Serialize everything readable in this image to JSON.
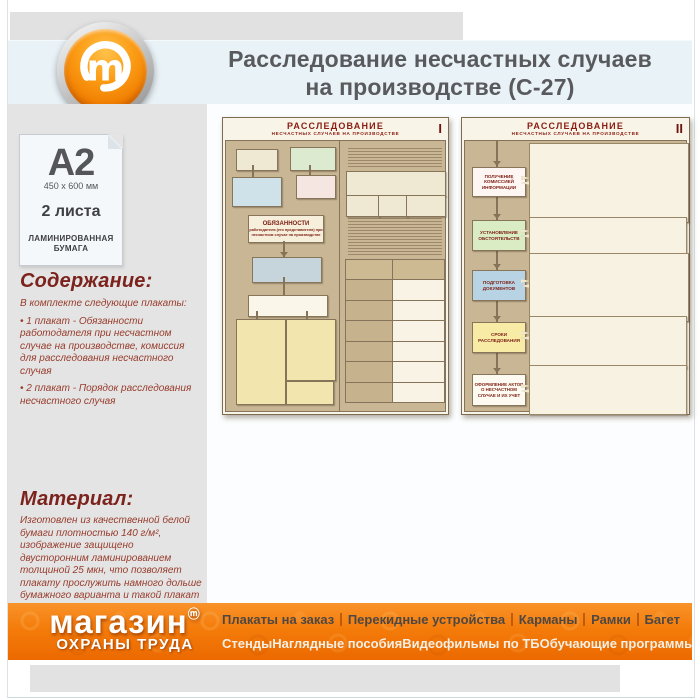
{
  "header": {
    "title_line1": "Расследование несчастных случаев",
    "title_line2": "на производстве (С-27)",
    "logo_letter": "m"
  },
  "sidebar": {
    "paper_format": "A2",
    "paper_size": "450 x 600 мм",
    "sheets": "2 листа",
    "paper_type_line1": "ЛАМИНИРОВАННАЯ",
    "paper_type_line2": "БУМАГА",
    "contents_heading": "Содержание:",
    "contents_intro": "В комплекте следующие плакаты:",
    "contents_item1": "• 1 плакат - Обязанности работодателя при несчастном случае на производстве, комиссия для расследования несчастного случая",
    "contents_item2": "• 2 плакат - Порядок расследования несчастного случая",
    "material_heading": "Материал:",
    "material_text": "Изготовлен из качественной белой бумаги плотностью 140 г/м², изображение защищено двусторонним ламинированием толщиной 25 мкн, что позволяет плакату прослужить намного дольше бумажного варианта и такой плакат не боится влаги - его смело можно протирать."
  },
  "posters": {
    "poster1": {
      "title": "РАССЛЕДОВАНИЕ",
      "subtitle": "НЕСЧАСТНЫХ СЛУЧАЕВ НА ПРОИЗВОДСТВЕ",
      "numeral": "I",
      "duties_heading": "ОБЯЗАННОСТИ",
      "duties_sub": "работодателя (его представителя) при несчастном случае на производстве"
    },
    "poster2": {
      "title": "РАССЛЕДОВАНИЕ",
      "subtitle": "НЕСЧАСТНЫХ СЛУЧАЕВ НА ПРОИЗВОДСТВЕ",
      "numeral": "II",
      "steps": [
        "ПОЛУЧЕНИЕ КОМИССИЕЙ ИНФОРМАЦИИ",
        "УСТАНОВЛЕНИЕ ОБСТОЯТЕЛЬСТВ",
        "ПОДГОТОВКА ДОКУМЕНТОВ",
        "СРОКИ РАССЛЕДОВАНИЯ",
        "ОФОРМЛЕНИЕ АКТОВ О НЕСЧАСТНОМ СЛУЧАЕ И ИХ УЧЕТ"
      ]
    }
  },
  "footer": {
    "logo_line1": "магазин",
    "logo_mark": "ⓜ",
    "logo_line2": "ОХРАНЫ ТРУДА",
    "menu_row1": [
      "Плакаты на заказ",
      "Перекидные устройства",
      "Карманы",
      "Рамки",
      "Багет"
    ],
    "menu_row2": [
      "Стенды",
      "Наглядные пособия",
      "Видеофильмы по ТБ",
      "Обучающие программы"
    ]
  },
  "colors": {
    "accent_orange": "#f07c00",
    "heading_red": "#7b231c",
    "body_red": "#973b2b",
    "title_gray": "#595a5e",
    "poster_red": "#8b1d12"
  }
}
